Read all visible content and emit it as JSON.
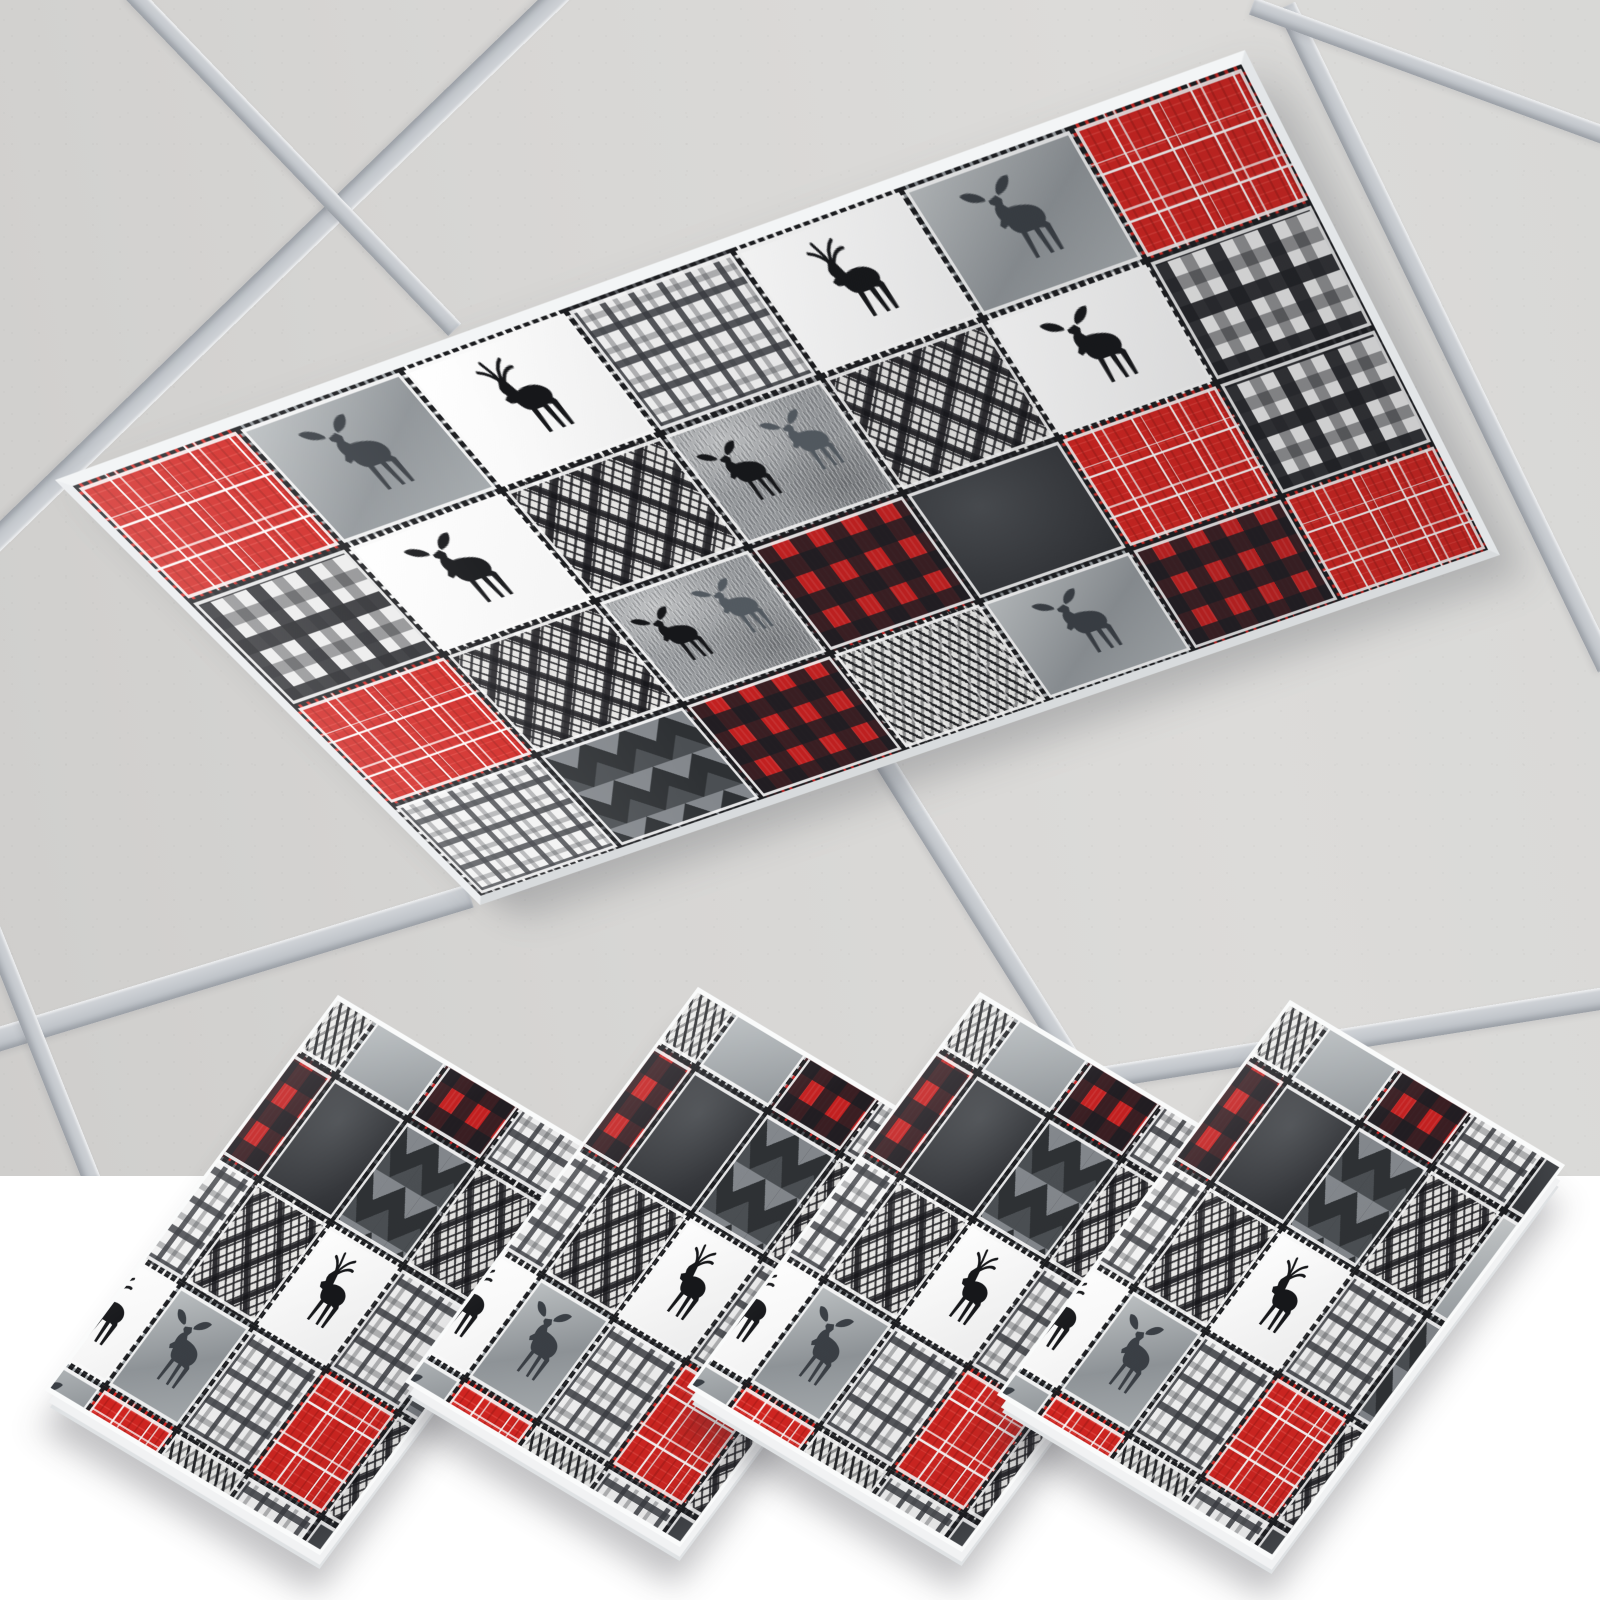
{
  "scene": {
    "description": "Lumberjack red and gray patchwork fluorescent light cover installed on a drop ceiling fixture, with four matching diamond-oriented cover panels fanned out below on a white background",
    "background_color": "#ffffff",
    "photo_region": {
      "x": 0,
      "y": 0,
      "width": 1600,
      "height": 1176
    },
    "backdrop_color": "#ffffff"
  },
  "ceiling": {
    "tile_color": "#d7d6d4",
    "tile_speckle_color": "#6e6e6a",
    "bar_color": "#c6cacf",
    "bars": [
      {
        "x1": 566,
        "y1": -12,
        "x2": -12,
        "y2": 548,
        "w": 22
      },
      {
        "x1": 131,
        "y1": -8,
        "x2": 455,
        "y2": 330,
        "w": 18
      },
      {
        "x1": 1286,
        "y1": 6,
        "x2": 1607,
        "y2": 668,
        "w": 20
      },
      {
        "x1": 1252,
        "y1": 6,
        "x2": 1606,
        "y2": 136,
        "w": 18
      },
      {
        "x1": -10,
        "y1": 1042,
        "x2": 470,
        "y2": 896,
        "w": 24
      },
      {
        "x1": 880,
        "y1": 755,
        "x2": 1085,
        "y2": 1082,
        "w": 20
      },
      {
        "x1": 1075,
        "y1": 1082,
        "x2": 1606,
        "y2": 998,
        "w": 22
      },
      {
        "x1": -8,
        "y1": 930,
        "x2": 92,
        "y2": 1180,
        "w": 18
      }
    ]
  },
  "palette": {
    "red": "#d12420",
    "dark_red": "#c32020",
    "charcoal": "#35373b",
    "near_black": "#1b1c1f",
    "light_gray": "#ececec",
    "mid_gray": "#96999c",
    "white": "#ffffff"
  },
  "patterns": [
    {
      "id": "red-windowpane",
      "label": "Red windowpane plaid"
    },
    {
      "id": "red-buffalo",
      "label": "Red and black buffalo check"
    },
    {
      "id": "gray-tartan",
      "label": "Black and white tartan plaid"
    },
    {
      "id": "gray-plaid",
      "label": "Gray tonal plaid"
    },
    {
      "id": "charcoal",
      "label": "Charcoal wash"
    },
    {
      "id": "gray-fern",
      "label": "Gray watercolor with fern"
    },
    {
      "id": "ikat",
      "label": "Black and white diamond ikat"
    },
    {
      "id": "chevron",
      "label": "Charcoal chevron"
    },
    {
      "id": "herringbone",
      "label": "Black and white herringbone"
    },
    {
      "id": "white-deer",
      "label": "Black deer silhouette on white"
    },
    {
      "id": "white-moose",
      "label": "Black moose silhouette on white"
    },
    {
      "id": "gray-moose",
      "label": "Moose silhouette on gray wash"
    },
    {
      "id": "fur-moose",
      "label": "Moose pair on textured gray"
    }
  ],
  "cover": {
    "name": "2x4 fluorescent light cover, lumberjack patchwork print",
    "quad": [
      [
        55,
        480
      ],
      [
        1245,
        50
      ],
      [
        1500,
        555
      ],
      [
        480,
        905
      ]
    ],
    "fabric_width": 1190,
    "fabric_height": 470,
    "cols": 7,
    "rows": 4,
    "patches": [
      [
        "red-windowpane",
        "gray-moose",
        "white-deer",
        "gray-plaid",
        "white-deer",
        "gray-moose",
        "red-windowpane"
      ],
      [
        "gray-tartan",
        "white-moose",
        "ikat",
        "fur-moose",
        "ikat",
        "white-moose",
        "gray-tartan"
      ],
      [
        "red-windowpane",
        "ikat",
        "fur-moose",
        "red-buffalo",
        "charcoal",
        "red-windowpane",
        "gray-tartan"
      ],
      [
        "gray-plaid",
        "chevron",
        "red-buffalo",
        "herringbone",
        "gray-moose",
        "red-buffalo",
        "red-windowpane"
      ]
    ]
  },
  "swatches": {
    "count": 4,
    "panel_size": 400,
    "cell_size": 105,
    "fabric_offset": 52,
    "tops": [
      [
        338,
        995
      ],
      [
        698,
        987
      ],
      [
        980,
        992
      ],
      [
        1290,
        1000
      ]
    ],
    "right_offset": [
      275,
      165
    ],
    "bottom_offset": [
      -18,
      560
    ],
    "left_offset": [
      -293,
      395
    ],
    "patches": [
      [
        "herringbone",
        "gray-fern",
        "red-buffalo",
        "gray-plaid",
        "charcoal"
      ],
      [
        "red-buffalo",
        "charcoal",
        "chevron",
        "ikat",
        "gray-fern"
      ],
      [
        "gray-plaid",
        "ikat",
        "white-deer",
        "gray-plaid",
        "chevron"
      ],
      [
        "white-deer",
        "gray-moose",
        "gray-plaid",
        "red-windowpane",
        "ikat"
      ],
      [
        "gray-moose",
        "red-windowpane",
        "herringbone",
        "gray-plaid",
        "charcoal"
      ]
    ]
  }
}
